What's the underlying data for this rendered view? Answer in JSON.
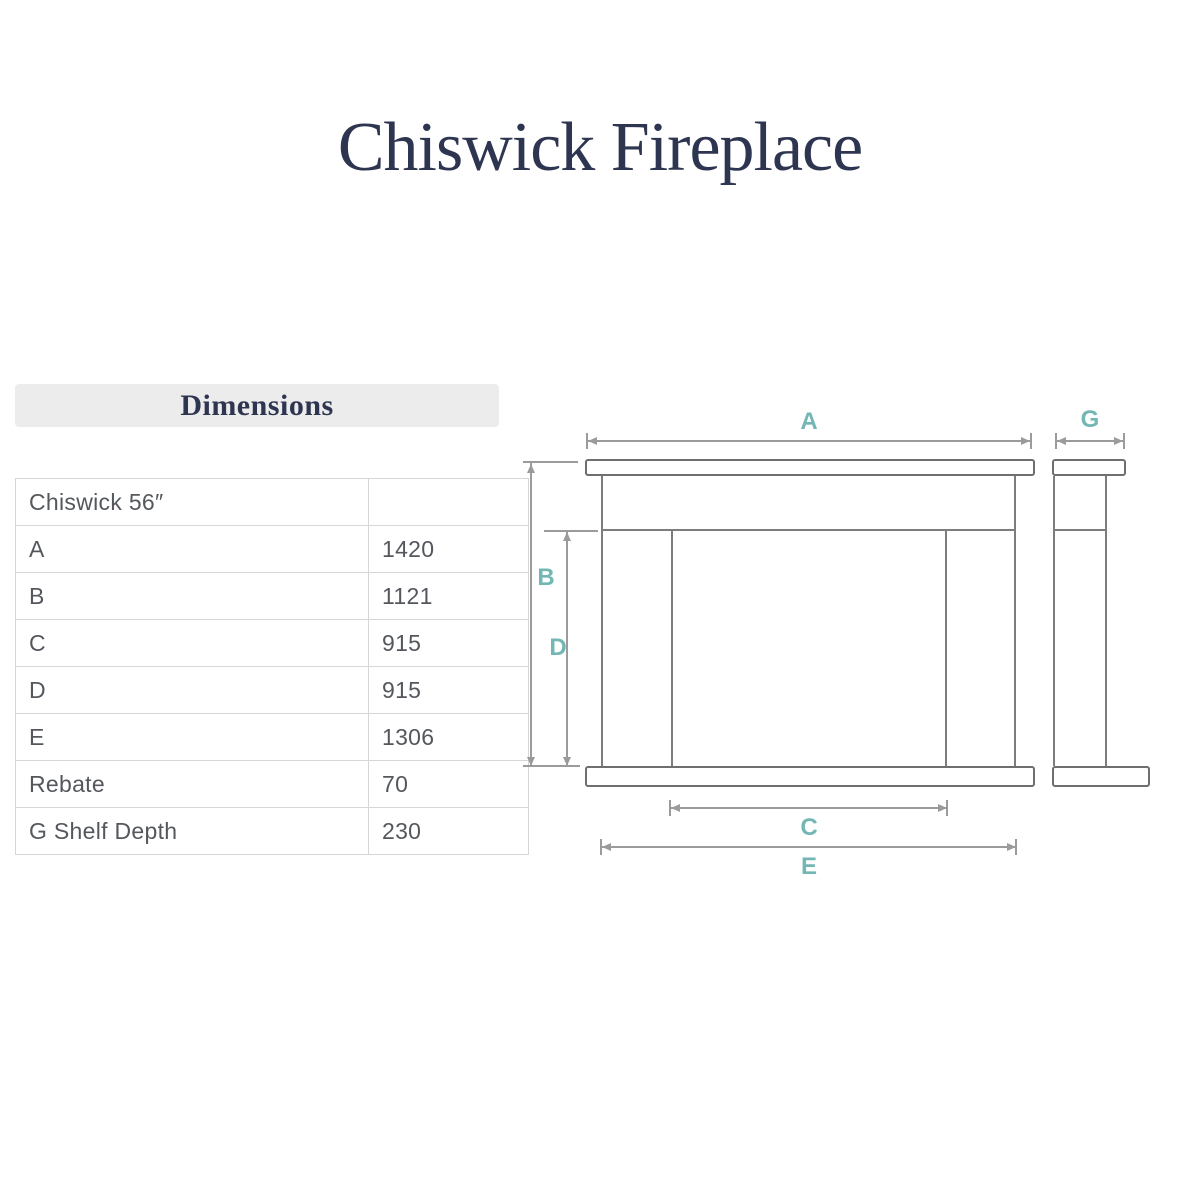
{
  "title": "Chiswick Fireplace",
  "dimensions_panel": {
    "header": "Dimensions",
    "rows": [
      {
        "label": "Chiswick 56″",
        "value": ""
      },
      {
        "label": "A",
        "value": "1420"
      },
      {
        "label": "B",
        "value": "1121"
      },
      {
        "label": "C",
        "value": "915"
      },
      {
        "label": "D",
        "value": "915"
      },
      {
        "label": "E",
        "value": "1306"
      },
      {
        "label": "Rebate",
        "value": "70"
      },
      {
        "label": "G Shelf Depth",
        "value": "230"
      }
    ]
  },
  "diagram": {
    "dim_labels": {
      "A": "A",
      "B": "B",
      "C": "C",
      "D": "D",
      "E": "E",
      "G": "G"
    }
  },
  "colors": {
    "accent_teal": "#72b7b3",
    "title_navy": "#2e3550",
    "table_text": "#54585d"
  }
}
